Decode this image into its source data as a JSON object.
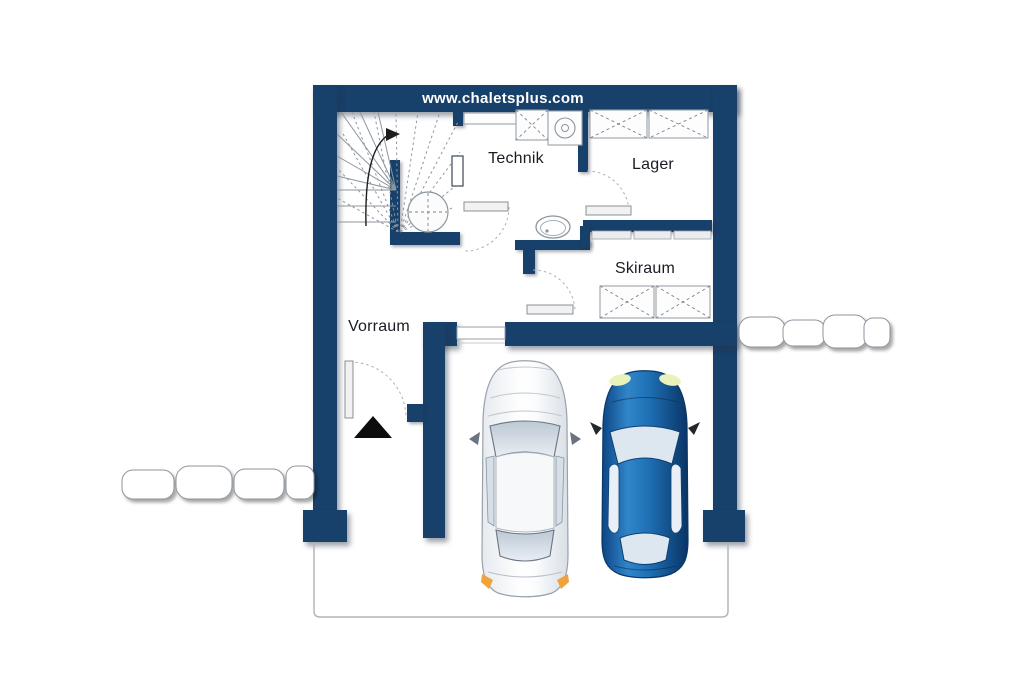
{
  "banner": {
    "website": "www.chaletsplus.com"
  },
  "rooms": {
    "technik": "Technik",
    "lager": "Lager",
    "skiraum": "Skiraum",
    "vorraum": "Vorraum"
  },
  "colors": {
    "wall": "#17406a",
    "background": "#ffffff",
    "banner_text": "#ffffff",
    "label_text": "#1b1b24",
    "outline_gray": "#9aa2ab",
    "line_dark": "#1d1d1d",
    "car_blue": "#1e6fb4",
    "car_white": "#f6f8fa",
    "glass_gray": "#c9d3de",
    "indicator_orange": "#f0a23c",
    "headlight_yellow": "#eaf2bc",
    "stone_white": "#ffffff"
  },
  "fixtures": {
    "staircase": "winder-staircase",
    "boiler": "boiler-tank",
    "washer": "washing-machine",
    "toilet": "toilet",
    "storage": "storage-crate",
    "shelves": "wall-shelves",
    "white_car": "white-car",
    "blue_car": "blue-car",
    "entrance_arrow": "entrance-arrow",
    "stones": "stepping-stones"
  }
}
